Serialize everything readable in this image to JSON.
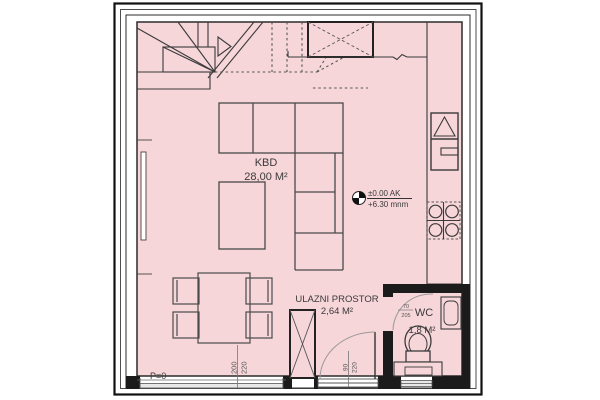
{
  "drawing": {
    "type": "architectural-floor-plan",
    "rooms": {
      "kbd": {
        "name": "KBD",
        "area": "28,00 M²"
      },
      "entry": {
        "name": "ULAZNI PROSTOR",
        "area": "2,64 M²"
      },
      "wc": {
        "name": "WC",
        "area": "1,8 M²"
      }
    },
    "elevation_marker": {
      "line1": "±0.00 AK",
      "line2": "+6.30 mnm"
    },
    "dims": {
      "parapet_label": "P=0",
      "window_w": "200",
      "window_h": "220",
      "entry_door_w": "90",
      "entry_door_h": "220",
      "wc_door_w": "70",
      "wc_door_h": "205"
    },
    "colors": {
      "floor": "#f7d6da",
      "line": "#3a3a3a",
      "wall": "#1b1b1b",
      "furniture_line": "#4a4a4a",
      "dim_line": "#777777"
    }
  }
}
